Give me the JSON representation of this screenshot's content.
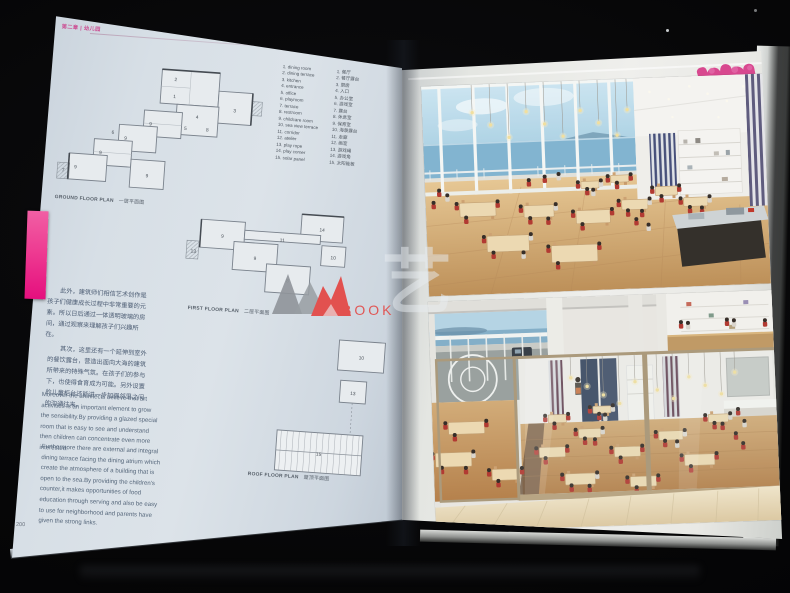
{
  "page_meta": {
    "chapter_header": "第二章 | 幼儿园",
    "page_number": "200"
  },
  "legend": {
    "en": [
      "1. dining room",
      "2. dining terrace",
      "3. kitchen",
      "4. entrance",
      "5. office",
      "6. playroom",
      "7. terrace",
      "8. restroom",
      "9. childcare room",
      "10. sea view terrace",
      "11. corridor",
      "12. atelier",
      "13. play rope",
      "14. play corner",
      "15. solar panel"
    ],
    "zh": [
      "1. 餐厅",
      "2. 餐厅露台",
      "3. 厨房",
      "4. 入口",
      "5. 办公室",
      "6. 游戏室",
      "7. 露台",
      "8. 休息室",
      "9. 保育室",
      "10. 海景露台",
      "11. 走廊",
      "12. 画室",
      "13. 游戏绳",
      "14. 游戏角",
      "15. 太阳能板"
    ]
  },
  "plans": {
    "ground": {
      "caption_en": "GROUND FLOOR PLAN",
      "caption_zh": "一层平面图",
      "labels": [
        [
          "2",
          117,
          15
        ],
        [
          "1",
          117,
          32
        ],
        [
          "3",
          178,
          42
        ],
        [
          "4",
          141,
          51
        ],
        [
          "9",
          95,
          61
        ],
        [
          "8",
          152,
          63
        ],
        [
          "9",
          71,
          77
        ],
        [
          "6",
          58,
          72
        ],
        [
          "9",
          47,
          93
        ],
        [
          "9",
          23,
          109
        ],
        [
          "9",
          95,
          113
        ],
        [
          "5",
          130,
          63
        ],
        [
          "7",
          11,
          113
        ]
      ]
    },
    "first": {
      "caption_en": "FIRST FLOOR PLAN",
      "caption_zh": "二层平面图",
      "labels": [
        [
          "14",
          139,
          24
        ],
        [
          "9",
          40,
          37
        ],
        [
          "9",
          74,
          57
        ],
        [
          "11",
          100,
          37
        ],
        [
          "10",
          152,
          51
        ],
        [
          "8",
          108,
          77
        ],
        [
          "13",
          12,
          54
        ]
      ]
    },
    "roof": {
      "caption_en": "ROOF FLOOR PLAN",
      "caption_zh": "屋顶平面图",
      "labels": [
        [
          "10",
          81,
          22
        ],
        [
          "13",
          75,
          58
        ],
        [
          "15",
          45,
          121
        ]
      ]
    }
  },
  "paragraphs": {
    "zh_1": "此外，建筑师们相信艺术创作是孩子们健康成长过程中非常重要的元素。所以日后通过一体透明玻璃的房间，通过观察来理解孩子们兴趣所在。",
    "zh_2": "其次，这里还有一个延伸到室外的餐饮露台，营造出面向大海的建筑所带来的特殊气氛。在孩子们的参与下，也使得食育成为可能。另外设置的儿童柜台还能进一步加强邻里之间的沟通往来。",
    "en_1": "Moreover the architects believe that art activities is an important element to grow the sensibility.By providing a glazed special room that is easy to see and understand then children can concentrate even more interested.",
    "en_2": "Furthermore there are external and integral dining terrace facing the dining atrium which create the atmosphere of a building that is open to the sea.By providing the children's counter,it makes opportunities of food education through serving and also be easy to use for neighborhood and parents have given the strong links."
  },
  "watermark": {
    "text": "BOOK",
    "glyph": "艺",
    "red": "#e2514f",
    "gray": "#8f9499"
  },
  "colors": {
    "tab_pink": "#ee3c92",
    "logo_pink": "#d8488f",
    "uniform_red": "#b23a32",
    "wood_floor": "#c9a36e"
  }
}
